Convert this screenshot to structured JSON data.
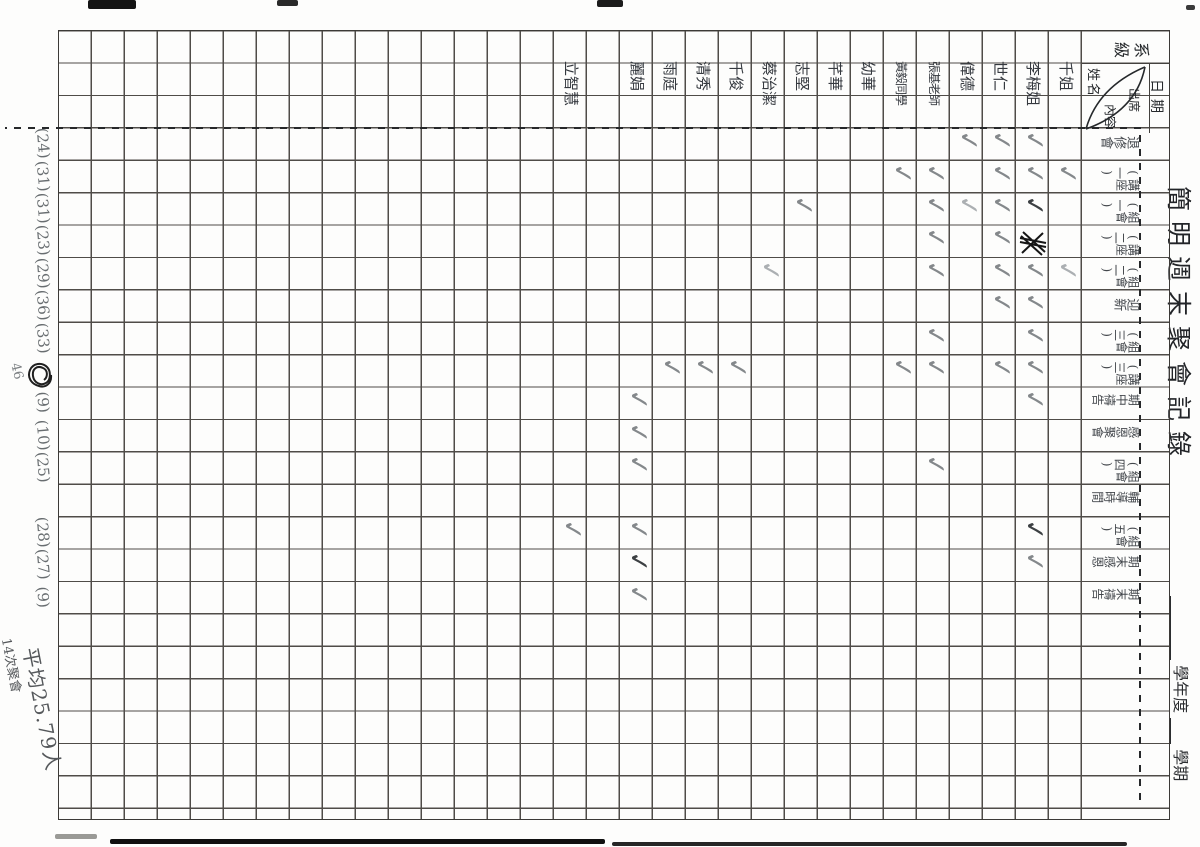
{
  "sheet": {
    "title": "簡明週末聚會記錄",
    "year_label": "學年度",
    "term_label": "學期",
    "corner": {
      "class_label": "系級",
      "date_label": "日期",
      "name_label": "姓名",
      "content_label_1": "出席",
      "content_label_2": "內容"
    },
    "events": [
      {
        "label": "退修會",
        "total": "(24)"
      },
      {
        "label": "講座(一)",
        "total": "(31)"
      },
      {
        "label": "組會(一)",
        "total": "(31)"
      },
      {
        "label": "講座(二)",
        "total": "(23)"
      },
      {
        "label": "組會(二)",
        "total": "(29)"
      },
      {
        "label": "迎新",
        "total": "(36)"
      },
      {
        "label": "組會(三)",
        "total": "(33)"
      },
      {
        "label": "講座(三)",
        "total": "",
        "total_scribbled": true,
        "total_note": "46"
      },
      {
        "label": "期中禱告",
        "total": "(9)"
      },
      {
        "label": "感恩聚會",
        "total": "(10)"
      },
      {
        "label": "組會(四)",
        "total": "(25)"
      },
      {
        "label": "輔導時間",
        "total": ""
      },
      {
        "label": "組會(五)",
        "total": "(28)"
      },
      {
        "label": "期末感恩",
        "total": "(27)"
      },
      {
        "label": "期末禱告",
        "total": "(9)"
      }
    ],
    "people": [
      {
        "name": "千姐"
      },
      {
        "name": "李梅姐"
      },
      {
        "name": "世仁"
      },
      {
        "name": "偉德"
      },
      {
        "name": "張基老師"
      },
      {
        "name": "黃毅同學"
      },
      {
        "name": "幼華"
      },
      {
        "name": "芊華"
      },
      {
        "name": "志堅"
      },
      {
        "name": "蔡治潔"
      },
      {
        "name": "千俊"
      },
      {
        "name": "清秀"
      },
      {
        "name": "雨庭"
      },
      {
        "name": "麗娟"
      },
      {
        "name": ""
      },
      {
        "name": "立智慧"
      }
    ],
    "checks": [
      {
        "e": 1,
        "p": 2
      },
      {
        "e": 1,
        "p": 3
      },
      {
        "e": 1,
        "p": 4
      },
      {
        "e": 2,
        "p": 1
      },
      {
        "e": 2,
        "p": 2
      },
      {
        "e": 2,
        "p": 3
      },
      {
        "e": 2,
        "p": 5
      },
      {
        "e": 2,
        "p": 6
      },
      {
        "e": 3,
        "p": 2,
        "s": "d"
      },
      {
        "e": 3,
        "p": 3
      },
      {
        "e": 3,
        "p": 4,
        "s": "l"
      },
      {
        "e": 3,
        "p": 5
      },
      {
        "e": 3,
        "p": 9
      },
      {
        "e": 4,
        "p": 3
      },
      {
        "e": 4,
        "p": 5
      },
      {
        "e": 5,
        "p": 1,
        "s": "l"
      },
      {
        "e": 5,
        "p": 2
      },
      {
        "e": 5,
        "p": 3
      },
      {
        "e": 5,
        "p": 5
      },
      {
        "e": 5,
        "p": 10,
        "s": "l"
      },
      {
        "e": 6,
        "p": 2
      },
      {
        "e": 6,
        "p": 3
      },
      {
        "e": 7,
        "p": 2
      },
      {
        "e": 7,
        "p": 5
      },
      {
        "e": 8,
        "p": 2
      },
      {
        "e": 8,
        "p": 3
      },
      {
        "e": 8,
        "p": 5
      },
      {
        "e": 8,
        "p": 6
      },
      {
        "e": 8,
        "p": 11
      },
      {
        "e": 8,
        "p": 12
      },
      {
        "e": 8,
        "p": 13
      },
      {
        "e": 9,
        "p": 2
      },
      {
        "e": 9,
        "p": 14
      },
      {
        "e": 10,
        "p": 14
      },
      {
        "e": 11,
        "p": 5
      },
      {
        "e": 11,
        "p": 14
      },
      {
        "e": 13,
        "p": 2,
        "s": "d"
      },
      {
        "e": 13,
        "p": 14
      },
      {
        "e": 13,
        "p": 16
      },
      {
        "e": 14,
        "p": 2
      },
      {
        "e": 14,
        "p": 14,
        "s": "d"
      },
      {
        "e": 15,
        "p": 14
      }
    ],
    "scribbled_check": {
      "e": 4,
      "p": 2
    },
    "summary": {
      "average": "平均25.79人",
      "meetings": "14次聚會"
    }
  }
}
